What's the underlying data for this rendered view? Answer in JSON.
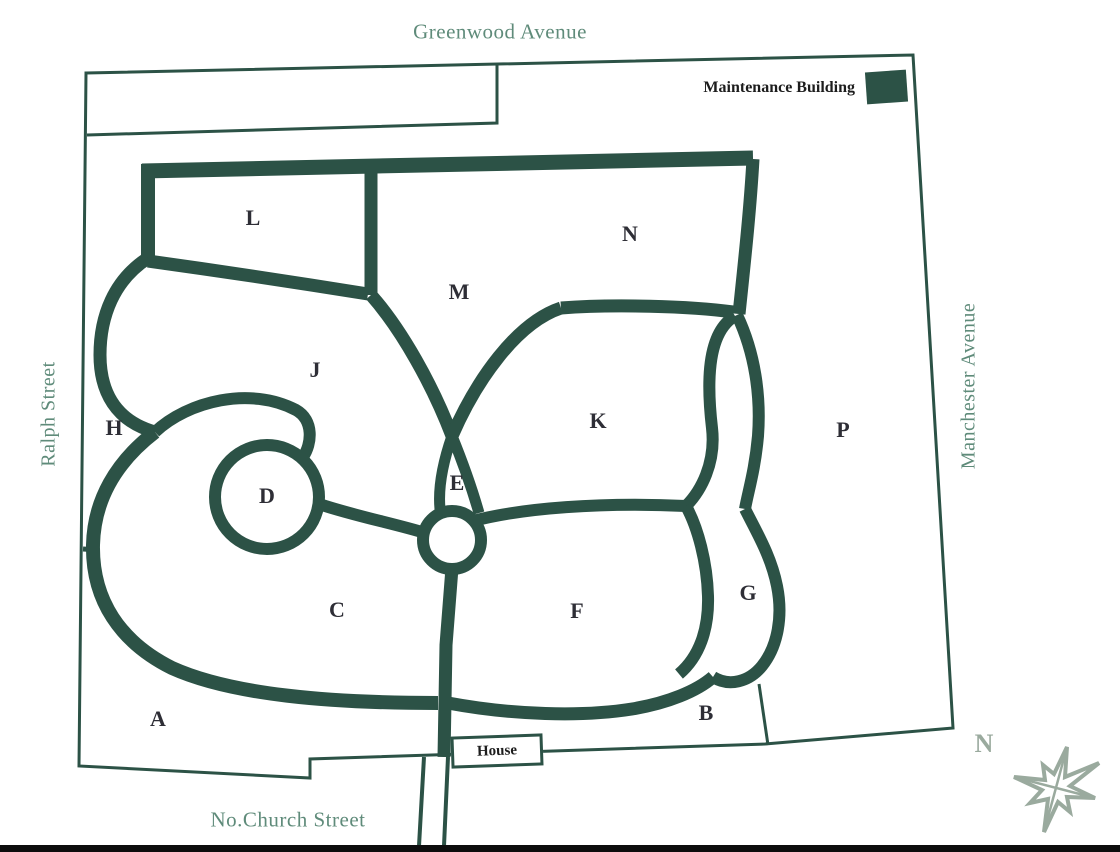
{
  "map": {
    "streets": {
      "top": "Greenwood Avenue",
      "left": "Ralph Street",
      "right": "Manchester Avenue",
      "bottom": "No.Church Street"
    },
    "labels": {
      "maintenance_building": "Maintenance Building",
      "house": "House",
      "compass_north": "N"
    },
    "sections": [
      {
        "id": "A",
        "x": 158,
        "y": 719
      },
      {
        "id": "B",
        "x": 706,
        "y": 713
      },
      {
        "id": "C",
        "x": 337,
        "y": 610
      },
      {
        "id": "D",
        "x": 267,
        "y": 496
      },
      {
        "id": "E",
        "x": 457,
        "y": 483
      },
      {
        "id": "F",
        "x": 577,
        "y": 611
      },
      {
        "id": "G",
        "x": 748,
        "y": 593
      },
      {
        "id": "H",
        "x": 114,
        "y": 428
      },
      {
        "id": "J",
        "x": 315,
        "y": 370
      },
      {
        "id": "K",
        "x": 598,
        "y": 421
      },
      {
        "id": "L",
        "x": 253,
        "y": 218
      },
      {
        "id": "M",
        "x": 459,
        "y": 292
      },
      {
        "id": "N",
        "x": 630,
        "y": 234
      },
      {
        "id": "P",
        "x": 843,
        "y": 430
      }
    ],
    "colors": {
      "road": "#2c5246",
      "street_text": "#5f8b7a",
      "section_text": "#2e2e36",
      "compass": "#9aaa9e"
    }
  }
}
